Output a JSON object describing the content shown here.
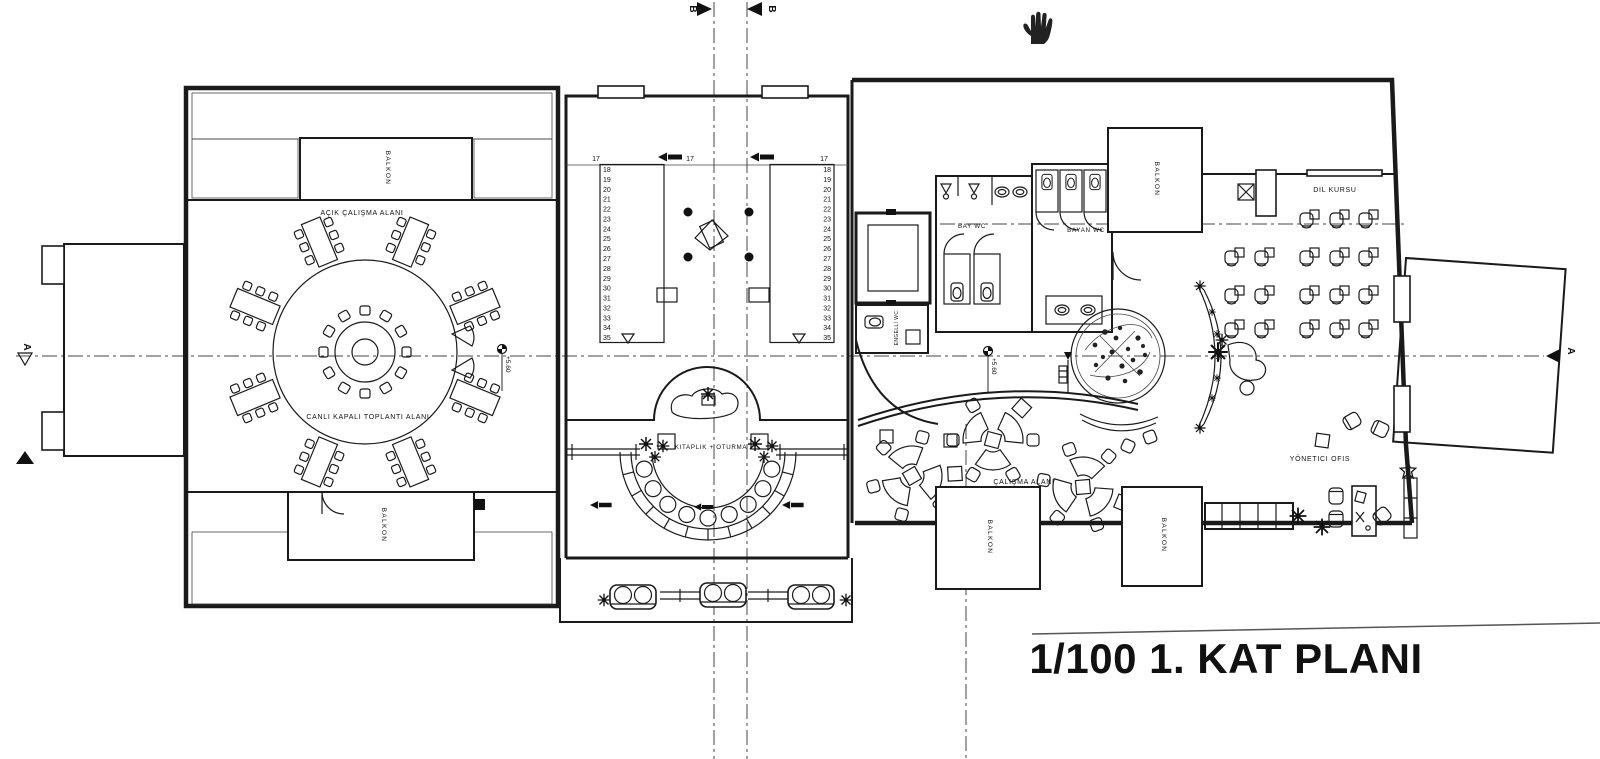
{
  "title": "1/100 1. KAT PLANI",
  "rooms": {
    "acik_calisma": "AÇIK ÇALIŞMA ALANI",
    "canli_toplanti": "CANLI KAPALI TOPLANTI ALANI",
    "kitaplik_oturma": "KITAPLIK + OTURMA",
    "bay_wc": "BAY WC",
    "bayan_wc": "BAYAN WC",
    "engelli_wc": "ENGELLİ WC",
    "dil_kursu": "DIL KURSU",
    "calisma_alani": "ÇALIŞMA ALANI",
    "yonetici_ofis": "YÖNETICI OFIS",
    "balkon": "BALKON"
  },
  "levels": {
    "value": "+5.60"
  },
  "markers": {
    "section_a": "A",
    "section_b": "B"
  },
  "stairs": {
    "landing": "17",
    "steps": [
      "18",
      "19",
      "20",
      "21",
      "22",
      "23",
      "24",
      "25",
      "26",
      "27",
      "28",
      "29",
      "30",
      "31",
      "32",
      "33",
      "34",
      "35"
    ]
  },
  "icons": {
    "cursor": "hand-pan-cursor"
  },
  "colors": {
    "ink": "#1a1a1a",
    "background": "#ffffff"
  }
}
